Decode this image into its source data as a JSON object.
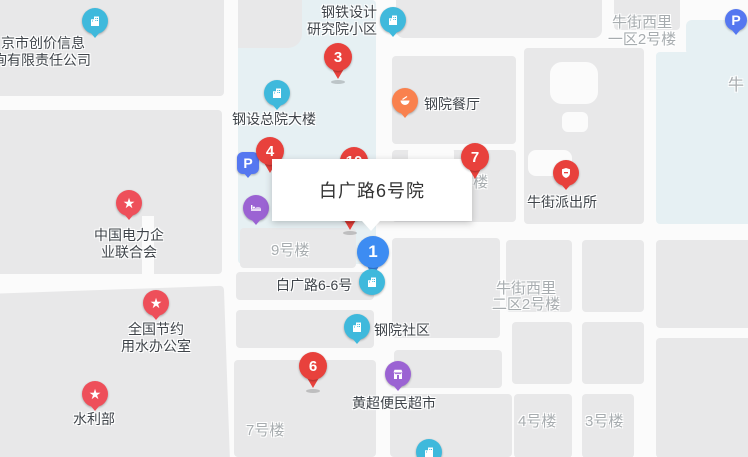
{
  "colors": {
    "red": "#E8413C",
    "starred": "#EE4F5A",
    "orange": "#F9814E",
    "cyan": "#3FB9DC",
    "bluepin": "#3D8CF2",
    "parking": "#5577F0",
    "purple": "#9B63D3",
    "road": "#FBFBFB",
    "block": "#E8E8E9",
    "green": "#E6F0F3"
  },
  "tooltip": {
    "text": "白广路6号院"
  },
  "pins": {
    "p1": "1",
    "p3": "3",
    "p4": "4",
    "p6": "6",
    "p7": "7",
    "p10": "10"
  },
  "markers": {
    "parking": "P"
  },
  "poi": {
    "chuangjia": {
      "line1": "京市创价信息",
      "line2": "询有限责任公司"
    },
    "gangtie": {
      "line1": "钢铁设计",
      "line2": "研究院小区"
    },
    "gangshe": {
      "label": "钢设总院大楼"
    },
    "canting": {
      "label": "钢院餐厅"
    },
    "paichusuo": {
      "label": "牛街派出所"
    },
    "dianli": {
      "line1": "中国电力企",
      "line2": "业联合会"
    },
    "jieyue": {
      "line1": "全国节约",
      "line2": "用水办公室"
    },
    "shuilibu": {
      "label": "水利部"
    },
    "baiguang66": {
      "label": "白广路6-6号"
    },
    "shequ": {
      "label": "钢院社区"
    },
    "chaoshi": {
      "label": "黄超便民超市"
    }
  },
  "buildings": {
    "b9": "9号楼",
    "b7": "7号楼",
    "b4": "4号楼",
    "b3": "3号楼",
    "niu": "牛",
    "partial": "号楼",
    "nw1": {
      "line1": "牛街西里",
      "line2": "一区2号楼"
    },
    "nw2": {
      "line1": "牛街西里",
      "line2": "二区2号楼"
    }
  }
}
